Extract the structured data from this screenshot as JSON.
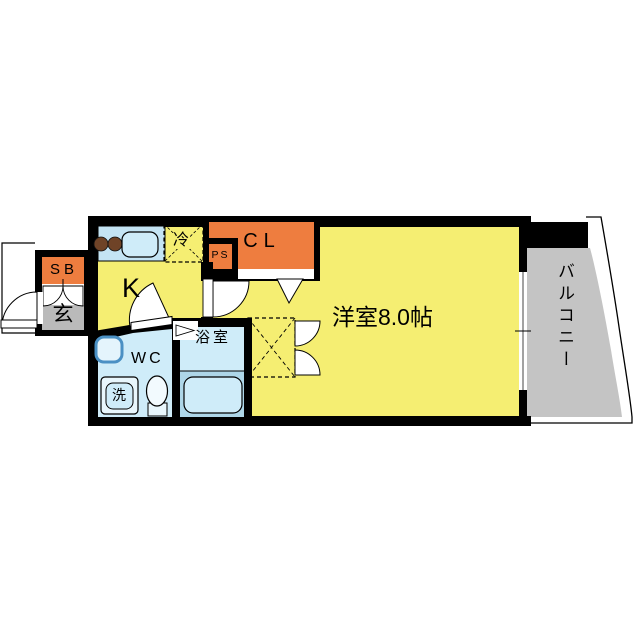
{
  "title": "apartment-floor-plan",
  "floor_plan": {
    "labels": {
      "main_room": "洋室8.0帖",
      "kitchen": "K",
      "balcony": "バルコニー",
      "entrance": "玄",
      "shoe_box": "SB",
      "closet": "CL",
      "pipe_space": "PS",
      "refrigerator": "冷",
      "toilet_room": "WC",
      "bathroom": "浴室",
      "washing_machine": "洗"
    },
    "colors": {
      "room_yellow": "#f5ee72",
      "accent_orange": "#ee7d3f",
      "entrance_gray": "#bababa",
      "balcony_gray": "#c4c4c4",
      "water_blue": "#cfecf9",
      "counter_blue": "#c4e4f4",
      "bath_lower_blue": "#aed6e8",
      "tub_blue": "#cfecf9",
      "burner_brown": "#6f4327",
      "wall_black": "#000000"
    }
  }
}
